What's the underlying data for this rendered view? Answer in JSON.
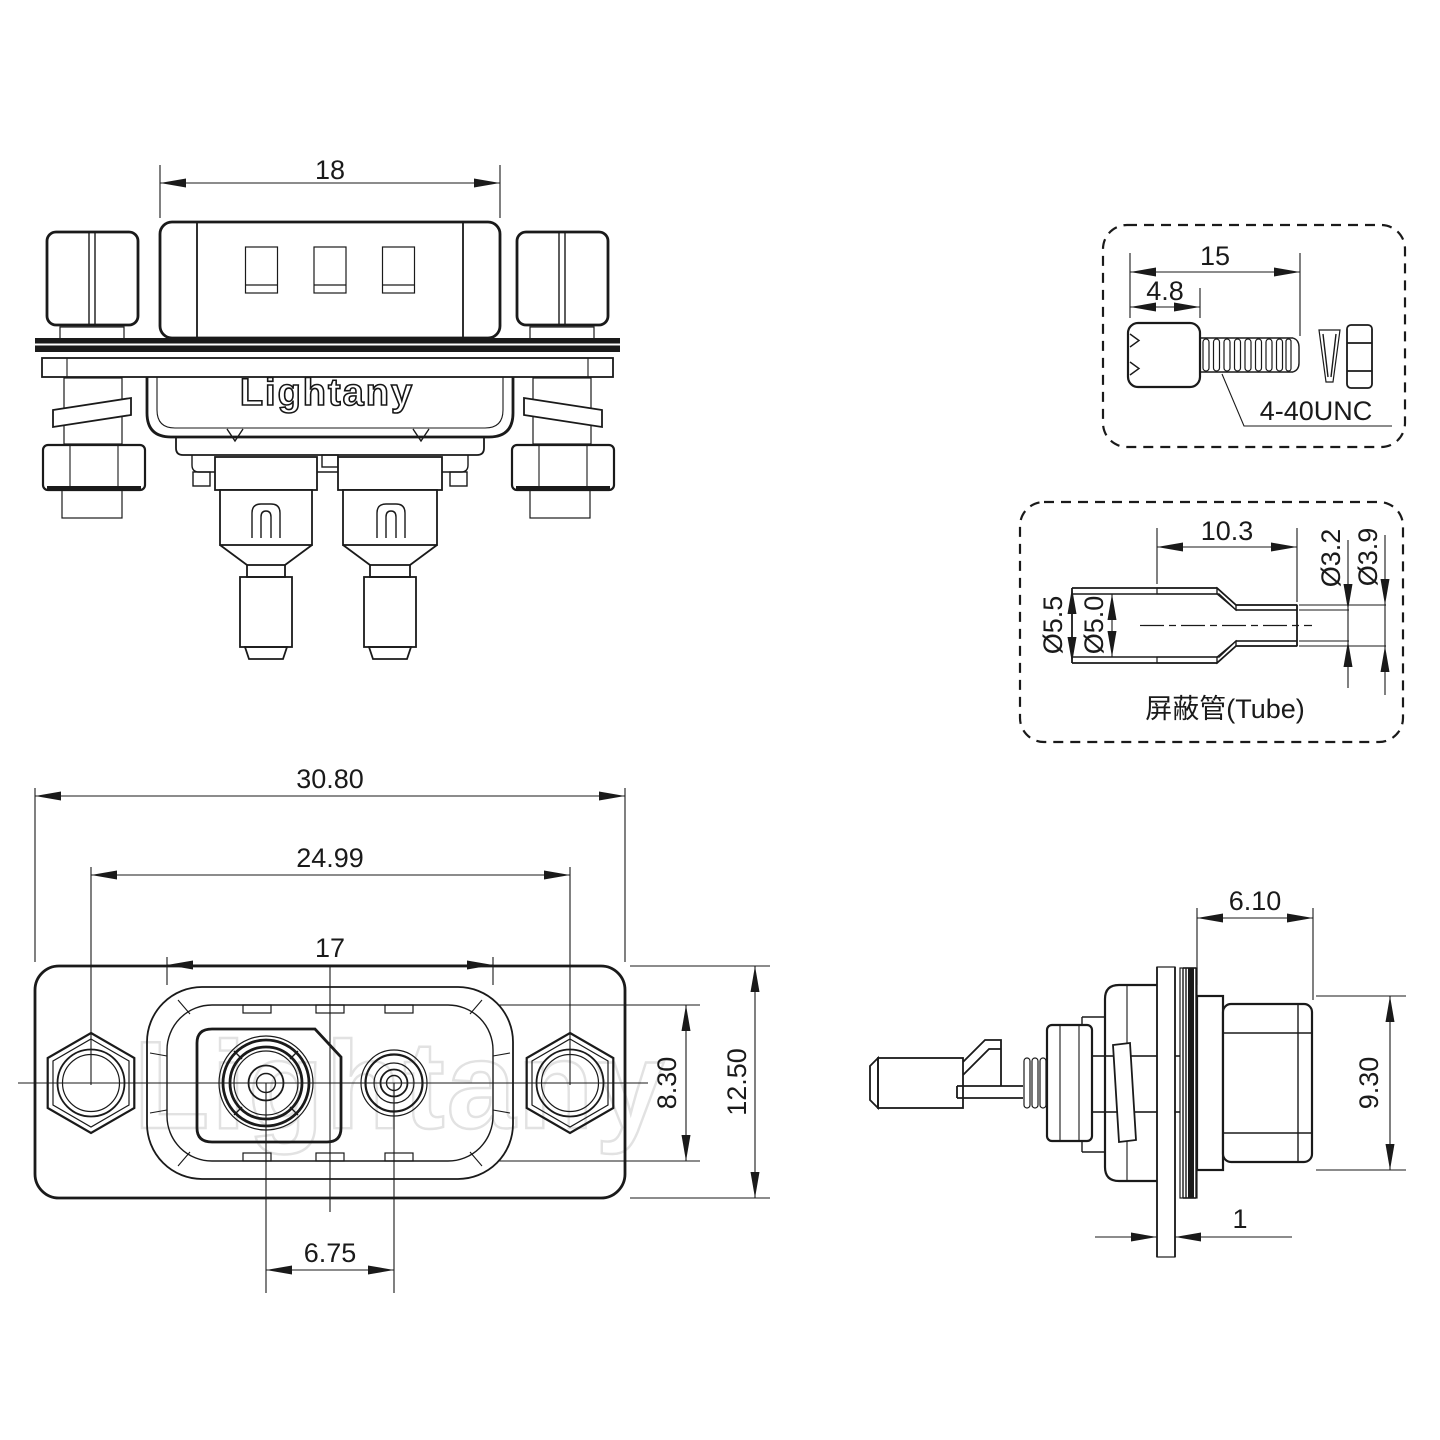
{
  "brand": {
    "logo": "Lightany",
    "watermark": "Lightany"
  },
  "colors": {
    "line": "#1a1a1a",
    "red": "#e8000f",
    "watermark": "#e2e2e2"
  },
  "top_view": {
    "dim_shell_width": "18"
  },
  "screw_detail": {
    "dim_total_length": "15",
    "dim_head_length": "4.8",
    "thread_spec": "4-40UNC"
  },
  "tube_detail": {
    "dim_sleeve_length": "10.3",
    "dim_small_inner_dia": "Ø3.2",
    "dim_small_outer_dia": "Ø3.9",
    "dim_large_outer_dia": "Ø5.5",
    "dim_large_inner_dia": "Ø5.0",
    "label": "屏蔽管(Tube)"
  },
  "front_view": {
    "dim_overall_width": "30.80",
    "dim_mount_spacing": "24.99",
    "dim_shell_width": "17",
    "dim_contact_spacing": "6.75",
    "dim_shell_height": "8.30",
    "dim_flange_height": "12.50"
  },
  "side_view": {
    "dim_body_depth": "6.10",
    "dim_body_height": "9.30",
    "dim_panel_thickness": "1"
  }
}
